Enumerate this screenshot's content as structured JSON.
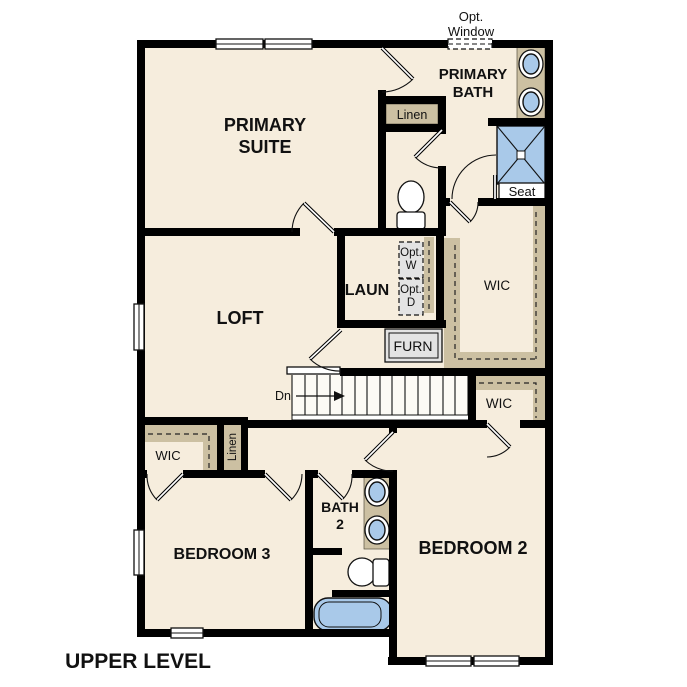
{
  "labels": {
    "opt_window": [
      "Opt.",
      "Window"
    ],
    "primary_bath": [
      "PRIMARY",
      "BATH"
    ],
    "primary_suite": [
      "PRIMARY",
      "SUITE"
    ],
    "linen_primary": "Linen",
    "laundry": "LAUN",
    "opt_washer": [
      "Opt.",
      "W"
    ],
    "opt_dryer": [
      "Opt.",
      "D"
    ],
    "wic_primary": "WIC",
    "furnace": "FURN",
    "seat": "Seat",
    "stairs_down": "Dn",
    "wic_bedroom2": "WIC",
    "wic_bedroom3": "WIC",
    "linen_hall": "Linen",
    "loft": "LOFT",
    "bath2": [
      "BATH",
      "2"
    ],
    "bedroom2": "BEDROOM 2",
    "bedroom3": "BEDROOM 3",
    "title": "UPPER LEVEL"
  },
  "colors": {
    "wall": "#000000",
    "floor": "#f6eddd",
    "counter": "#ccc0a2",
    "fixture": "#a9c9e9",
    "appliance": "#e3e3e3",
    "text": "#111111"
  }
}
